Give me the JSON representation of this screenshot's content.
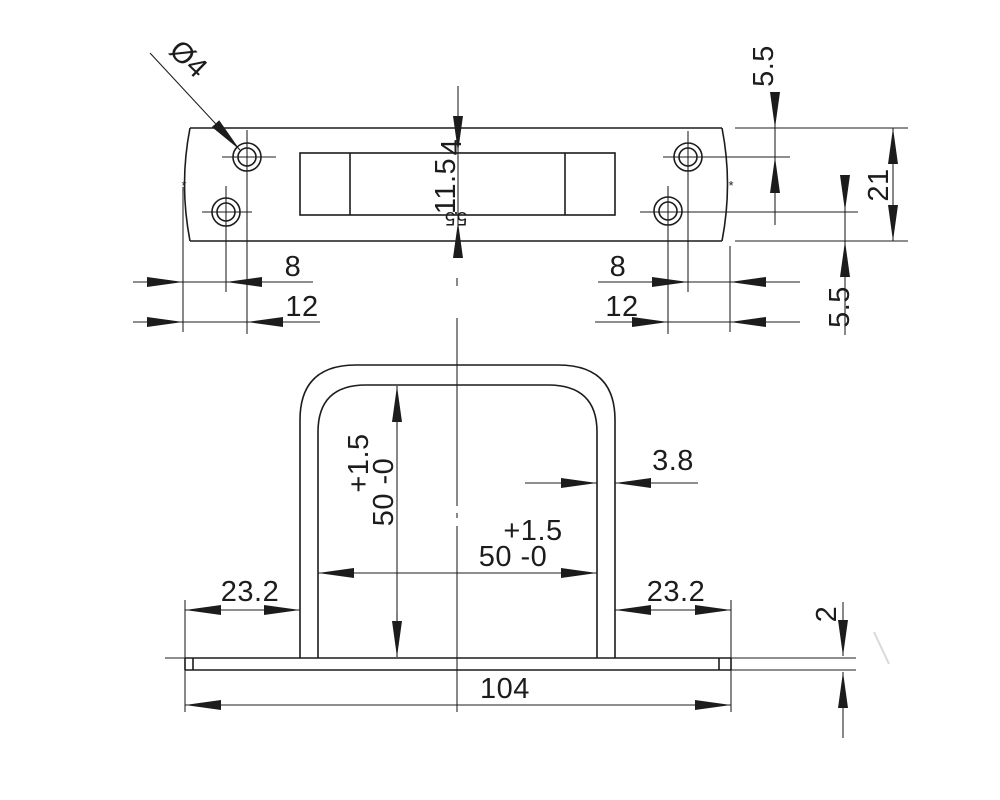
{
  "drawing": {
    "top_view": {
      "hole_diameter_label": "Ø4",
      "slot_top_offset": "4",
      "slot_height": "11.5",
      "slot_bottom_offset": "5.5",
      "edge_to_hole_center_top": "5.5",
      "plate_width": "21",
      "hole_center_to_edge_bottom": "5.5",
      "left_edge_to_lower_hole": "8",
      "left_edge_to_upper_hole": "12",
      "upper_hole_to_right_edge": "8",
      "lower_hole_to_right_edge": "12",
      "arc_marker": "*"
    },
    "front_view": {
      "opening_height_tolerance": "+1.5",
      "opening_height": "50 -0",
      "opening_width_tolerance": "+1.5",
      "opening_width": "50 -0",
      "wall_thickness": "3.8",
      "left_flange_width": "23.2",
      "right_flange_width": "23.2",
      "base_length": "104",
      "base_thickness": "2"
    }
  }
}
